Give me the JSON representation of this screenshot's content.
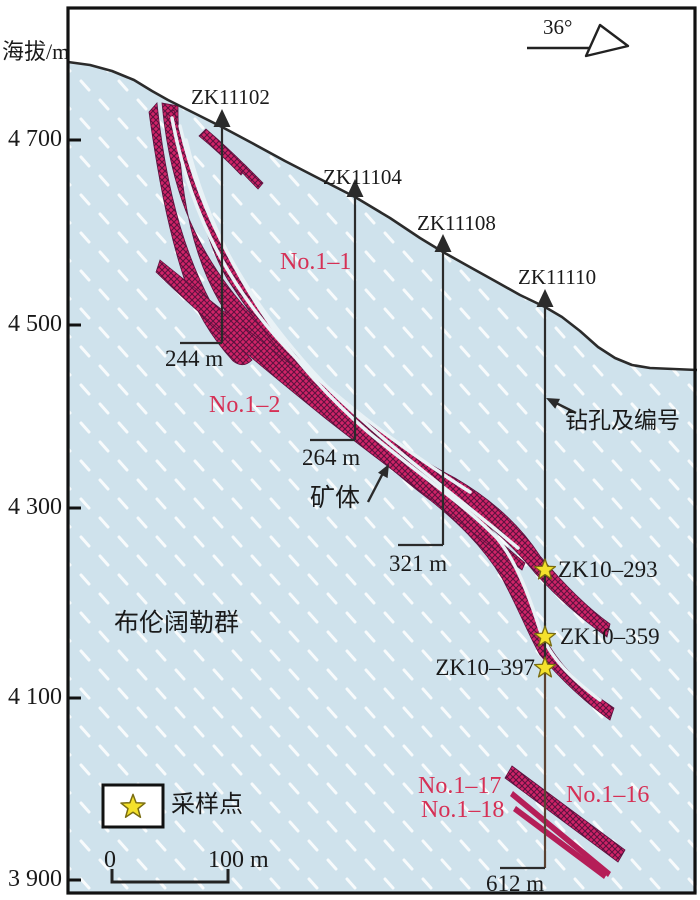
{
  "axis": {
    "label": "海拔/m",
    "unit": "m",
    "ticks": [
      "4 700",
      "4 500",
      "4 300",
      "4 100",
      "3 900"
    ]
  },
  "north_arrow": {
    "bearing": "36°"
  },
  "drills": [
    {
      "name": "ZK11102",
      "depth": "244 m"
    },
    {
      "name": "ZK11104",
      "depth": "264 m"
    },
    {
      "name": "ZK11108",
      "depth": "321 m"
    },
    {
      "name": "ZK11110",
      "depth": "612 m"
    }
  ],
  "ore_labels": {
    "no1_1": "No.1–1",
    "no1_2": "No.1–2",
    "no1_16": "No.1–16",
    "no1_17": "No.1–17",
    "no1_18": "No.1–18"
  },
  "samples": [
    {
      "id": "ZK10–293"
    },
    {
      "id": "ZK10–359"
    },
    {
      "id": "ZK10–397"
    }
  ],
  "annotations": {
    "drillhole_callout": "钻孔及编号",
    "ore_body": "矿体",
    "rock_group": "布伦阔勒群"
  },
  "legend": {
    "sample_point": "采样点"
  },
  "scale_bar": {
    "zero": "0",
    "max": "100 m"
  },
  "colors": {
    "background_rock": "#cfe2ec",
    "ore_fill": "#d02367",
    "ore_hatch": "#5c123f",
    "label_red": "#d63055",
    "star_fill": "#f4e12c",
    "line_dark": "#2b2b2b"
  }
}
